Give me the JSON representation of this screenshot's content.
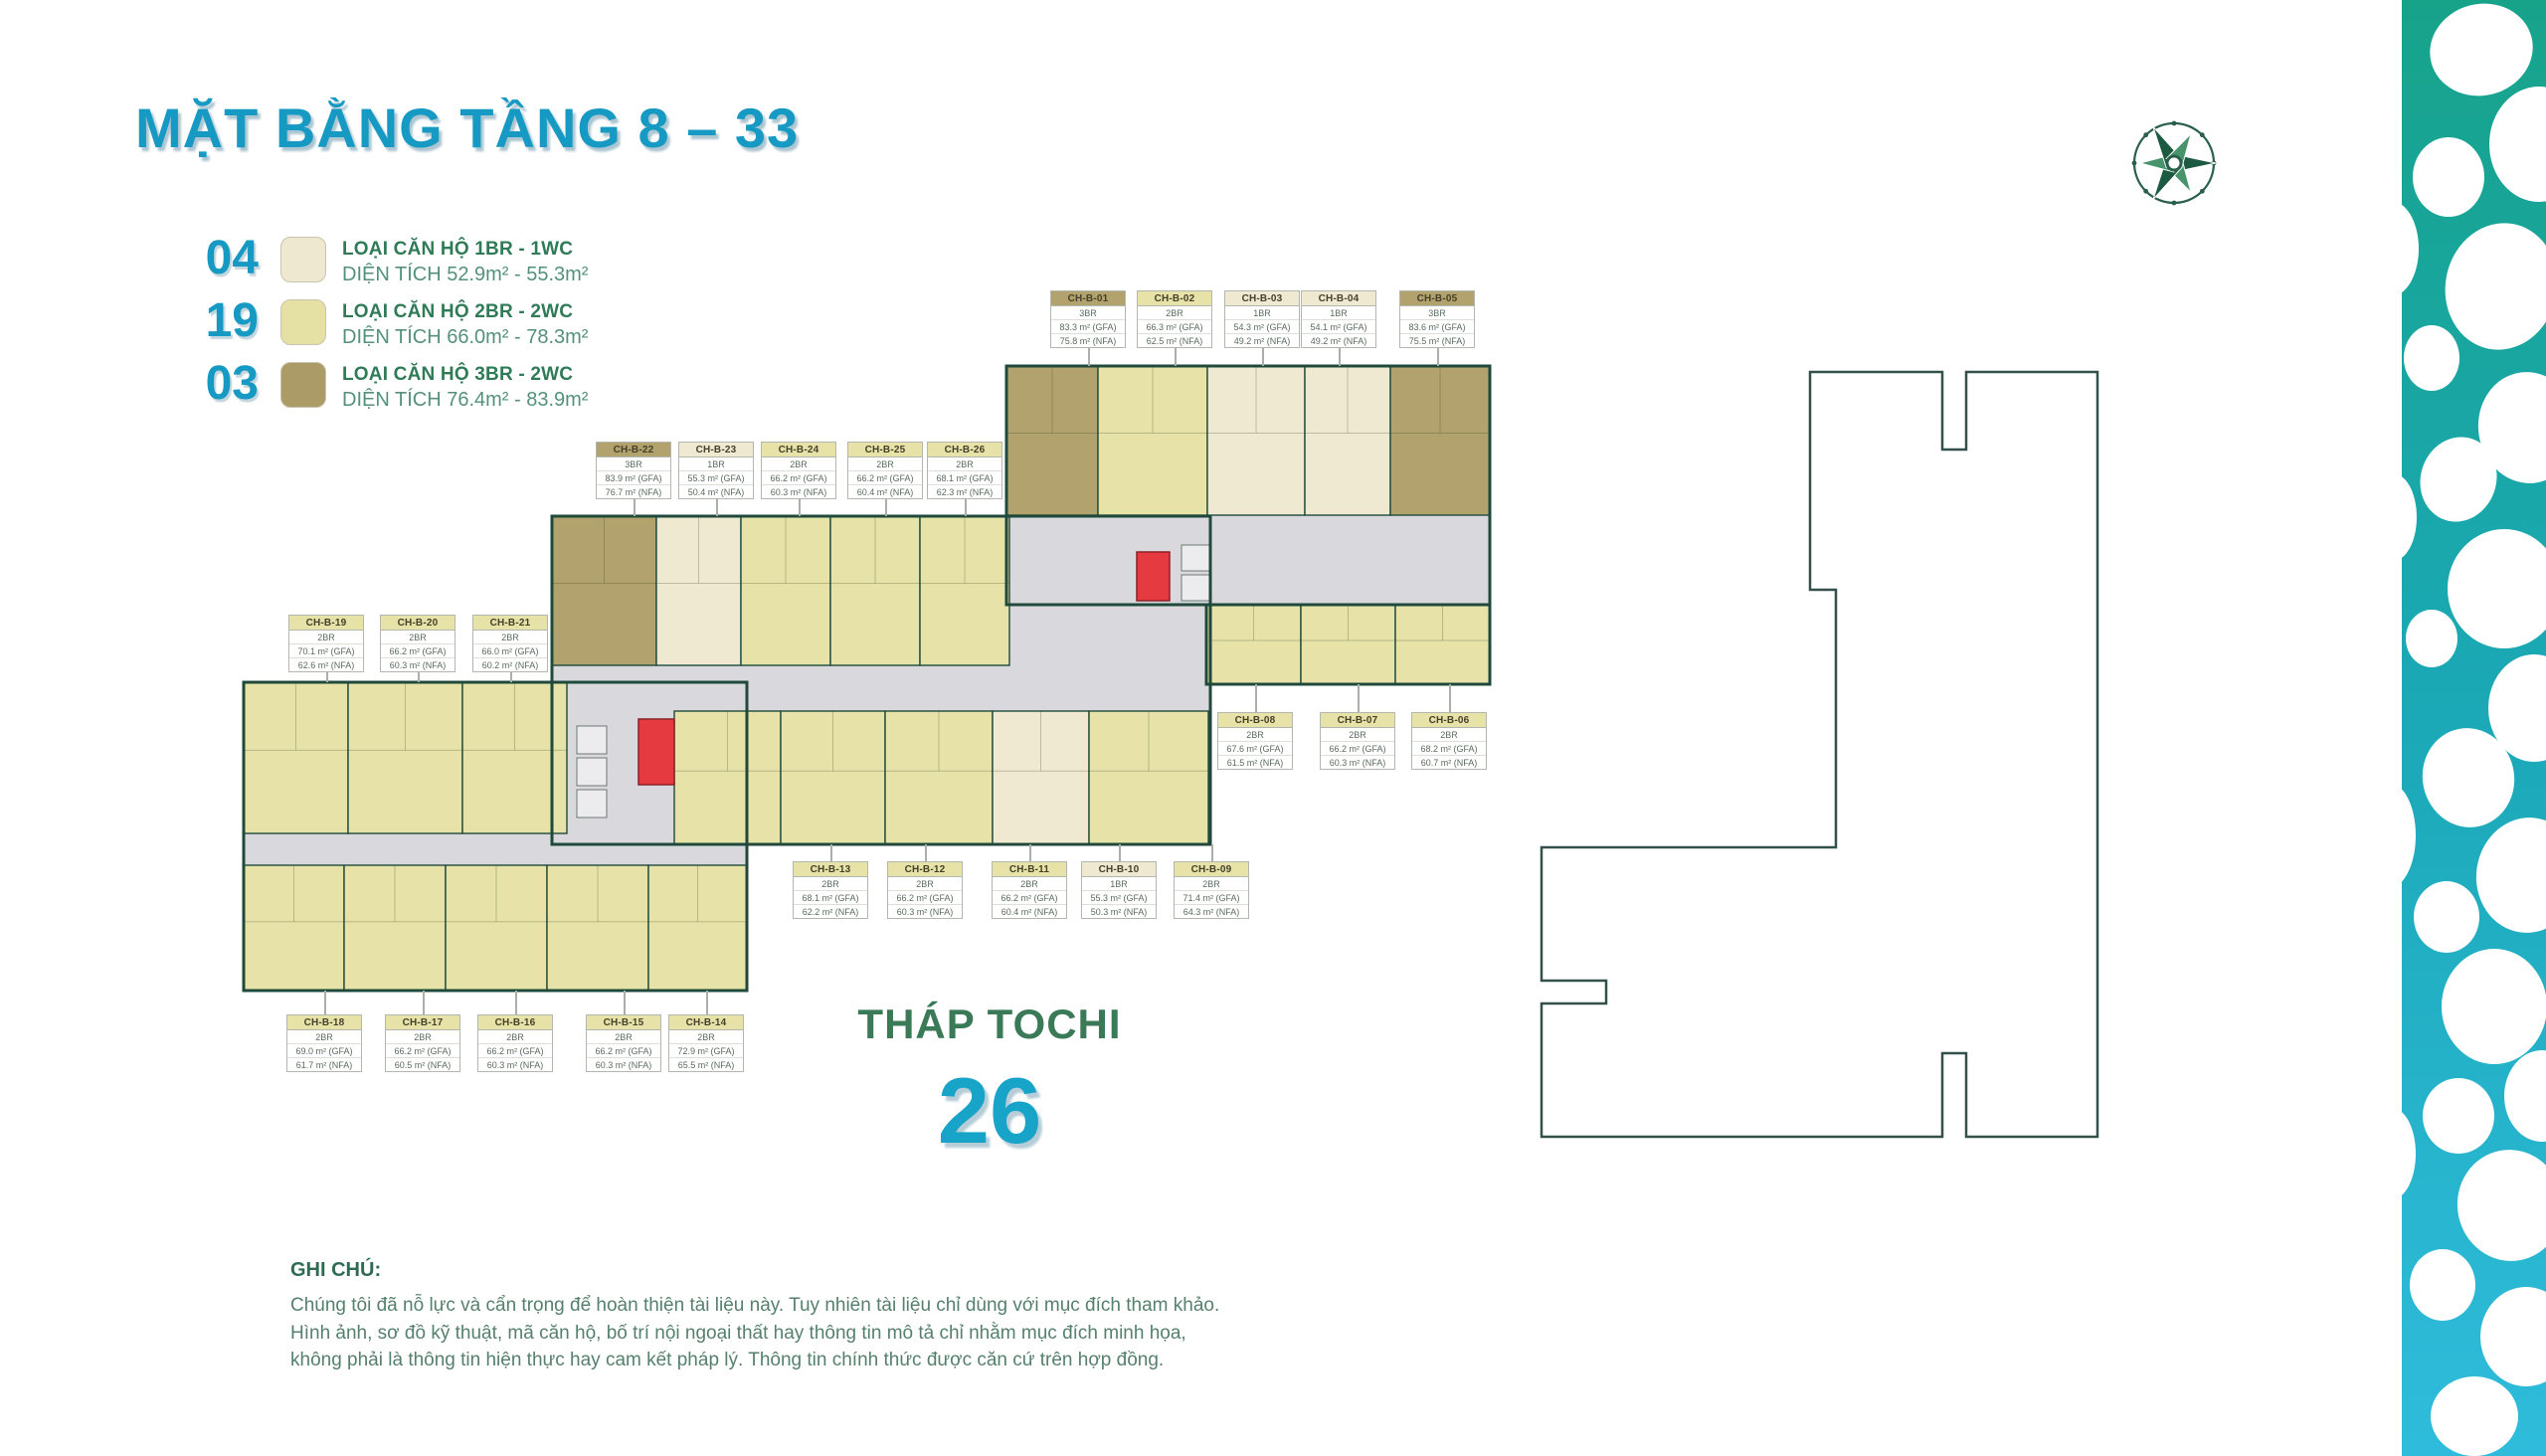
{
  "page": {
    "title": "MẶT BẰNG TẦNG 8 – 33"
  },
  "legend": {
    "items": [
      {
        "count": "04",
        "type": "1BR",
        "label": "LOẠI CĂN HỘ 1BR - 1WC",
        "area": "DIỆN TÍCH 52.9m² - 55.3m²",
        "color": "#efe8d0"
      },
      {
        "count": "19",
        "type": "2BR",
        "label": "LOẠI CĂN HỘ 2BR - 2WC",
        "area": "DIỆN TÍCH 66.0m² - 78.3m²",
        "color": "#e5e1a4"
      },
      {
        "count": "03",
        "type": "3BR",
        "label": "LOẠI CĂN HỘ 3BR - 2WC",
        "area": "DIỆN TÍCH 76.4m² - 83.9m²",
        "color": "#ab9b66"
      }
    ]
  },
  "tower": {
    "name": "THÁP TOCHI",
    "total_units": "26"
  },
  "note": {
    "heading": "GHI CHÚ:",
    "body": "Chúng tôi đã nỗ lực và cẩn trọng để hoàn thiện tài liệu này. Tuy nhiên tài liệu chỉ dùng với mục đích tham khảo. Hình ảnh, sơ đồ kỹ thuật, mã căn hộ, bố trí nội ngoại thất hay thông tin mô tả chỉ nhằm mục đích minh họa, không phải là thông tin hiện thực hay cam kết pháp lý. Thông tin chính thức được căn cứ trên hợp đồng."
  },
  "units": [
    {
      "code": "CH-B-01",
      "type": "3BR",
      "gfa": "83.3 m² (GFA)",
      "nfa": "75.8 m² (NFA)"
    },
    {
      "code": "CH-B-02",
      "type": "2BR",
      "gfa": "66.3 m² (GFA)",
      "nfa": "62.5 m² (NFA)"
    },
    {
      "code": "CH-B-03",
      "type": "1BR",
      "gfa": "54.3 m² (GFA)",
      "nfa": "49.2 m² (NFA)"
    },
    {
      "code": "CH-B-04",
      "type": "1BR",
      "gfa": "54.1 m² (GFA)",
      "nfa": "49.2 m² (NFA)"
    },
    {
      "code": "CH-B-05",
      "type": "3BR",
      "gfa": "83.6 m² (GFA)",
      "nfa": "75.5 m² (NFA)"
    },
    {
      "code": "CH-B-06",
      "type": "2BR",
      "gfa": "68.2 m² (GFA)",
      "nfa": "60.7 m² (NFA)"
    },
    {
      "code": "CH-B-07",
      "type": "2BR",
      "gfa": "66.2 m² (GFA)",
      "nfa": "60.3 m² (NFA)"
    },
    {
      "code": "CH-B-08",
      "type": "2BR",
      "gfa": "67.6 m² (GFA)",
      "nfa": "61.5 m² (NFA)"
    },
    {
      "code": "CH-B-09",
      "type": "2BR",
      "gfa": "71.4 m² (GFA)",
      "nfa": "64.3 m² (NFA)"
    },
    {
      "code": "CH-B-10",
      "type": "1BR",
      "gfa": "55.3 m² (GFA)",
      "nfa": "50.3 m² (NFA)"
    },
    {
      "code": "CH-B-11",
      "type": "2BR",
      "gfa": "66.2 m² (GFA)",
      "nfa": "60.4 m² (NFA)"
    },
    {
      "code": "CH-B-12",
      "type": "2BR",
      "gfa": "66.2 m² (GFA)",
      "nfa": "60.3 m² (NFA)"
    },
    {
      "code": "CH-B-13",
      "type": "2BR",
      "gfa": "68.1 m² (GFA)",
      "nfa": "62.2 m² (NFA)"
    },
    {
      "code": "CH-B-14",
      "type": "2BR",
      "gfa": "72.9 m² (GFA)",
      "nfa": "65.5 m² (NFA)"
    },
    {
      "code": "CH-B-15",
      "type": "2BR",
      "gfa": "66.2 m² (GFA)",
      "nfa": "60.3 m² (NFA)"
    },
    {
      "code": "CH-B-16",
      "type": "2BR",
      "gfa": "66.2 m² (GFA)",
      "nfa": "60.3 m² (NFA)"
    },
    {
      "code": "CH-B-17",
      "type": "2BR",
      "gfa": "66.2 m² (GFA)",
      "nfa": "60.5 m² (NFA)"
    },
    {
      "code": "CH-B-18",
      "type": "2BR",
      "gfa": "69.0 m² (GFA)",
      "nfa": "61.7 m² (NFA)"
    },
    {
      "code": "CH-B-19",
      "type": "2BR",
      "gfa": "70.1 m² (GFA)",
      "nfa": "62.6 m² (NFA)"
    },
    {
      "code": "CH-B-20",
      "type": "2BR",
      "gfa": "66.2 m² (GFA)",
      "nfa": "60.3 m² (NFA)"
    },
    {
      "code": "CH-B-21",
      "type": "2BR",
      "gfa": "66.0 m² (GFA)",
      "nfa": "60.2 m² (NFA)"
    },
    {
      "code": "CH-B-22",
      "type": "3BR",
      "gfa": "83.9 m² (GFA)",
      "nfa": "76.7 m² (NFA)"
    },
    {
      "code": "CH-B-23",
      "type": "1BR",
      "gfa": "55.3 m² (GFA)",
      "nfa": "50.4 m² (NFA)"
    },
    {
      "code": "CH-B-24",
      "type": "2BR",
      "gfa": "66.2 m² (GFA)",
      "nfa": "60.3 m² (NFA)"
    },
    {
      "code": "CH-B-25",
      "type": "2BR",
      "gfa": "66.2 m² (GFA)",
      "nfa": "60.4 m² (NFA)"
    },
    {
      "code": "CH-B-26",
      "type": "2BR",
      "gfa": "68.1 m² (GFA)",
      "nfa": "62.3 m² (NFA)"
    }
  ],
  "colors": {
    "accent": "#1699c2",
    "heading_green": "#2f7b57",
    "tower_green": "#3b7a58",
    "wall": "#1f4a3b",
    "corridor": "#d9d9dd",
    "core": "#e53a40",
    "unit_1BR": "#f0e9d2",
    "unit_2BR": "#e7e3a8",
    "unit_3BR": "#b2a26d"
  }
}
